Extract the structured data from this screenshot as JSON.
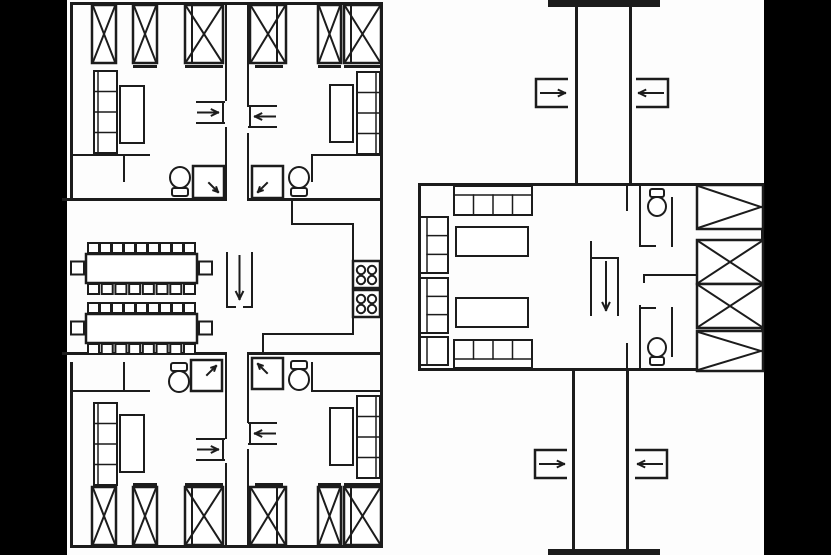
{
  "meta": {
    "title": "dormitory-floor-plan",
    "width": 831,
    "height": 555,
    "background_color": "#fdfdfd",
    "ink_color": "#1c1c1c",
    "margin_color": "#000000"
  },
  "plan": {
    "elements": [
      {
        "type": "bar",
        "name": "left-margin-bar",
        "x": 0,
        "y": 0,
        "w": 67,
        "h": 555,
        "fill": "#000000"
      },
      {
        "type": "bar",
        "name": "right-margin-bar",
        "x": 764,
        "y": 0,
        "w": 67,
        "h": 555,
        "fill": "#000000"
      },
      {
        "type": "bar",
        "name": "block-a-top-wall",
        "x": 70,
        "y": 2,
        "w": 313,
        "h": 3
      },
      {
        "type": "bar",
        "name": "block-a-left-wall-upper",
        "x": 70,
        "y": 2,
        "w": 3,
        "h": 198
      },
      {
        "type": "bar",
        "name": "block-a-left-wall-lower",
        "x": 70,
        "y": 362,
        "w": 3,
        "h": 186
      },
      {
        "type": "bar",
        "name": "block-a-right-wall",
        "x": 380,
        "y": 2,
        "w": 3,
        "h": 546
      },
      {
        "type": "bar",
        "name": "block-a-bottom-wall",
        "x": 70,
        "y": 545,
        "w": 313,
        "h": 3
      },
      {
        "type": "bar",
        "name": "block-a-upper-mid-wall-left",
        "x": 62,
        "y": 198,
        "w": 165,
        "h": 3
      },
      {
        "type": "bar",
        "name": "block-a-upper-mid-wall-right",
        "x": 247,
        "y": 198,
        "w": 136,
        "h": 3
      },
      {
        "type": "bar",
        "name": "block-a-lower-mid-wall-left",
        "x": 62,
        "y": 352,
        "w": 165,
        "h": 3
      },
      {
        "type": "bar",
        "name": "block-a-lower-mid-wall-right",
        "x": 247,
        "y": 352,
        "w": 136,
        "h": 3
      },
      {
        "type": "bar",
        "name": "top-strip-left-wall",
        "x": 225,
        "y": 2,
        "w": 2,
        "h": 99
      },
      {
        "type": "bar",
        "name": "top-strip-left-wall",
        "x": 225,
        "y": 127,
        "w": 2,
        "h": 74
      },
      {
        "type": "bar",
        "name": "top-strip-right-wall",
        "x": 247,
        "y": 2,
        "w": 2,
        "h": 105
      },
      {
        "type": "bar",
        "name": "top-strip-right-wall",
        "x": 247,
        "y": 133,
        "w": 2,
        "h": 68
      },
      {
        "type": "bar",
        "name": "bottom-strip-left-wall",
        "x": 225,
        "y": 355,
        "w": 2,
        "h": 84
      },
      {
        "type": "bar",
        "name": "bottom-strip-left-wall",
        "x": 225,
        "y": 463,
        "w": 2,
        "h": 82
      },
      {
        "type": "bar",
        "name": "bottom-strip-right-wall",
        "x": 247,
        "y": 355,
        "w": 2,
        "h": 68
      },
      {
        "type": "bar",
        "name": "bottom-strip-right-wall",
        "x": 247,
        "y": 449,
        "w": 2,
        "h": 96
      },
      {
        "type": "bar",
        "name": "kitchen-wall",
        "x": 291,
        "y": 201,
        "w": 2,
        "h": 24
      },
      {
        "type": "bar",
        "name": "kitchen-wall",
        "x": 291,
        "y": 223,
        "w": 63,
        "h": 2
      },
      {
        "type": "bar",
        "name": "kitchen-wall",
        "x": 352,
        "y": 223,
        "w": 2,
        "h": 112
      },
      {
        "type": "bar",
        "name": "kitchen-wall",
        "x": 262,
        "y": 333,
        "w": 92,
        "h": 2
      },
      {
        "type": "bar",
        "name": "kitchen-wall",
        "x": 262,
        "y": 333,
        "w": 2,
        "h": 21
      },
      {
        "type": "bar",
        "name": "wc-partition",
        "x": 70,
        "y": 154,
        "w": 80,
        "h": 2
      },
      {
        "type": "bar",
        "name": "wc-partition",
        "x": 123,
        "y": 154,
        "w": 2,
        "h": 28
      },
      {
        "type": "bar",
        "name": "wc-partition",
        "x": 311,
        "y": 154,
        "w": 70,
        "h": 2
      },
      {
        "type": "bar",
        "name": "wc-partition",
        "x": 311,
        "y": 154,
        "w": 2,
        "h": 28
      },
      {
        "type": "bar",
        "name": "wc-partition",
        "x": 70,
        "y": 390,
        "w": 80,
        "h": 2
      },
      {
        "type": "bar",
        "name": "wc-partition",
        "x": 123,
        "y": 362,
        "w": 2,
        "h": 28
      },
      {
        "type": "bar",
        "name": "wc-partition",
        "x": 311,
        "y": 390,
        "w": 70,
        "h": 2
      },
      {
        "type": "bar",
        "name": "wc-partition",
        "x": 311,
        "y": 362,
        "w": 2,
        "h": 28
      },
      {
        "type": "xbox",
        "name": "wardrobe-xbox",
        "x": 92,
        "y": 5,
        "w": 24,
        "h": 58
      },
      {
        "type": "xbox",
        "name": "wardrobe-xbox",
        "x": 133,
        "y": 5,
        "w": 24,
        "h": 58
      },
      {
        "type": "xbox",
        "name": "wardrobe-xbox",
        "x": 185,
        "y": 5,
        "w": 38,
        "h": 58
      },
      {
        "type": "bar",
        "name": "wardrobe-divider",
        "x": 191,
        "y": 5,
        "w": 2,
        "h": 58
      },
      {
        "type": "bar",
        "name": "wardrobe-foot",
        "x": 133,
        "y": 65,
        "w": 24,
        "h": 3
      },
      {
        "type": "bar",
        "name": "wardrobe-foot",
        "x": 185,
        "y": 65,
        "w": 38,
        "h": 3
      },
      {
        "type": "bed",
        "name": "bunk-shelf-bed",
        "x": 94,
        "y": 71,
        "w": 23,
        "h": 82,
        "side": "left"
      },
      {
        "type": "box",
        "name": "desk",
        "x": 120,
        "y": 86,
        "w": 24,
        "h": 57
      },
      {
        "type": "door-arrow",
        "name": "door-swing-arrow",
        "x": 197,
        "y": 102,
        "w": 27,
        "h": 21,
        "dir": "right"
      },
      {
        "type": "toilet",
        "name": "toilet-icon",
        "x": 169,
        "y": 166,
        "w": 22,
        "h": 31,
        "dir": "up"
      },
      {
        "type": "shower",
        "name": "shower-tray",
        "x": 193,
        "y": 166,
        "w": 31,
        "h": 32,
        "corner": "br"
      },
      {
        "type": "xbox",
        "name": "wardrobe-xbox",
        "x": 250,
        "y": 5,
        "w": 36,
        "h": 58
      },
      {
        "type": "bar",
        "name": "wardrobe-divider",
        "x": 276,
        "y": 5,
        "w": 2,
        "h": 58
      },
      {
        "type": "xbox",
        "name": "wardrobe-xbox",
        "x": 318,
        "y": 5,
        "w": 23,
        "h": 58
      },
      {
        "type": "xbox",
        "name": "wardrobe-xbox",
        "x": 344,
        "y": 5,
        "w": 37,
        "h": 58
      },
      {
        "type": "bar",
        "name": "wardrobe-divider",
        "x": 350,
        "y": 5,
        "w": 2,
        "h": 58
      },
      {
        "type": "bar",
        "name": "wardrobe-foot",
        "x": 255,
        "y": 65,
        "w": 28,
        "h": 3
      },
      {
        "type": "bar",
        "name": "wardrobe-foot",
        "x": 318,
        "y": 65,
        "w": 23,
        "h": 3
      },
      {
        "type": "bar",
        "name": "wardrobe-foot",
        "x": 344,
        "y": 65,
        "w": 37,
        "h": 3
      },
      {
        "type": "bed",
        "name": "bunk-shelf-bed",
        "x": 357,
        "y": 72,
        "w": 23,
        "h": 82,
        "side": "right"
      },
      {
        "type": "box",
        "name": "desk",
        "x": 330,
        "y": 85,
        "w": 23,
        "h": 57
      },
      {
        "type": "door-arrow",
        "name": "door-swing-arrow",
        "x": 249,
        "y": 106,
        "w": 27,
        "h": 21,
        "dir": "left"
      },
      {
        "type": "shower",
        "name": "shower-tray",
        "x": 252,
        "y": 166,
        "w": 31,
        "h": 32,
        "corner": "bl"
      },
      {
        "type": "toilet",
        "name": "toilet-icon",
        "x": 288,
        "y": 166,
        "w": 22,
        "h": 31,
        "dir": "up"
      },
      {
        "type": "table",
        "name": "dining-table",
        "x": 86,
        "y": 254,
        "w": 111,
        "h": 29,
        "top": 9,
        "bottom": 8
      },
      {
        "type": "table",
        "name": "dining-table",
        "x": 86,
        "y": 314,
        "w": 111,
        "h": 29,
        "top": 9,
        "bottom": 8
      },
      {
        "type": "entry-u",
        "name": "entrance-arrow",
        "x": 227,
        "y": 253,
        "w": 25,
        "h": 54
      },
      {
        "type": "stove",
        "name": "kitchen-stove",
        "x": 353,
        "y": 261,
        "w": 27,
        "h": 27
      },
      {
        "type": "stove",
        "name": "kitchen-stove",
        "x": 353,
        "y": 290,
        "w": 27,
        "h": 27
      },
      {
        "type": "toilet",
        "name": "toilet-icon",
        "x": 168,
        "y": 362,
        "w": 22,
        "h": 31,
        "dir": "down"
      },
      {
        "type": "shower",
        "name": "shower-tray",
        "x": 191,
        "y": 360,
        "w": 31,
        "h": 31,
        "corner": "tr"
      },
      {
        "type": "bed",
        "name": "bunk-shelf-bed",
        "x": 94,
        "y": 403,
        "w": 23,
        "h": 82,
        "side": "left"
      },
      {
        "type": "box",
        "name": "desk",
        "x": 120,
        "y": 415,
        "w": 24,
        "h": 57
      },
      {
        "type": "door-arrow",
        "name": "door-swing-arrow",
        "x": 197,
        "y": 439,
        "w": 27,
        "h": 21,
        "dir": "right"
      },
      {
        "type": "xbox",
        "name": "wardrobe-xbox",
        "x": 92,
        "y": 487,
        "w": 24,
        "h": 58
      },
      {
        "type": "xbox",
        "name": "wardrobe-xbox",
        "x": 133,
        "y": 487,
        "w": 24,
        "h": 58
      },
      {
        "type": "xbox",
        "name": "wardrobe-xbox",
        "x": 185,
        "y": 487,
        "w": 38,
        "h": 58
      },
      {
        "type": "bar",
        "name": "wardrobe-divider",
        "x": 191,
        "y": 487,
        "w": 2,
        "h": 58
      },
      {
        "type": "bar",
        "name": "wardrobe-foot",
        "x": 133,
        "y": 483,
        "w": 24,
        "h": 3
      },
      {
        "type": "bar",
        "name": "wardrobe-foot",
        "x": 185,
        "y": 483,
        "w": 38,
        "h": 3
      },
      {
        "type": "shower",
        "name": "shower-tray",
        "x": 252,
        "y": 358,
        "w": 31,
        "h": 31,
        "corner": "tl"
      },
      {
        "type": "toilet",
        "name": "toilet-icon",
        "x": 288,
        "y": 360,
        "w": 22,
        "h": 31,
        "dir": "down"
      },
      {
        "type": "bed",
        "name": "bunk-shelf-bed",
        "x": 357,
        "y": 396,
        "w": 23,
        "h": 82,
        "side": "right"
      },
      {
        "type": "box",
        "name": "desk",
        "x": 330,
        "y": 408,
        "w": 23,
        "h": 57
      },
      {
        "type": "door-arrow",
        "name": "door-swing-arrow",
        "x": 249,
        "y": 423,
        "w": 27,
        "h": 21,
        "dir": "left"
      },
      {
        "type": "xbox",
        "name": "wardrobe-xbox",
        "x": 250,
        "y": 487,
        "w": 36,
        "h": 58
      },
      {
        "type": "bar",
        "name": "wardrobe-divider",
        "x": 276,
        "y": 487,
        "w": 2,
        "h": 58
      },
      {
        "type": "xbox",
        "name": "wardrobe-xbox",
        "x": 318,
        "y": 487,
        "w": 23,
        "h": 58
      },
      {
        "type": "xbox",
        "name": "wardrobe-xbox",
        "x": 344,
        "y": 487,
        "w": 37,
        "h": 58
      },
      {
        "type": "bar",
        "name": "wardrobe-divider",
        "x": 350,
        "y": 487,
        "w": 2,
        "h": 58
      },
      {
        "type": "bar",
        "name": "wardrobe-foot",
        "x": 255,
        "y": 483,
        "w": 28,
        "h": 3
      },
      {
        "type": "bar",
        "name": "wardrobe-foot",
        "x": 318,
        "y": 483,
        "w": 23,
        "h": 3
      },
      {
        "type": "bar",
        "name": "wardrobe-foot",
        "x": 344,
        "y": 483,
        "w": 37,
        "h": 3
      },
      {
        "type": "bar",
        "name": "block-b-top-wall",
        "x": 418,
        "y": 183,
        "w": 346,
        "h": 3
      },
      {
        "type": "bar",
        "name": "block-b-bottom-wall",
        "x": 418,
        "y": 368,
        "w": 346,
        "h": 3
      },
      {
        "type": "bar",
        "name": "block-b-left-wall",
        "x": 418,
        "y": 183,
        "w": 3,
        "h": 188
      },
      {
        "type": "bar",
        "name": "block-b-right-wall",
        "x": 761,
        "y": 183,
        "w": 3,
        "h": 188
      },
      {
        "type": "bar",
        "name": "corridor-top-left-wall",
        "x": 575,
        "y": 6,
        "w": 3,
        "h": 177
      },
      {
        "type": "bar",
        "name": "corridor-top-right-wall",
        "x": 629,
        "y": 6,
        "w": 3,
        "h": 177
      },
      {
        "type": "bar",
        "name": "corridor-top-cap",
        "x": 548,
        "y": 0,
        "w": 112,
        "h": 7
      },
      {
        "type": "bar",
        "name": "corridor-bottom-left-wall",
        "x": 572,
        "y": 371,
        "w": 3,
        "h": 178
      },
      {
        "type": "bar",
        "name": "corridor-bottom-right-wall",
        "x": 626,
        "y": 371,
        "w": 3,
        "h": 178
      },
      {
        "type": "bar",
        "name": "corridor-bottom-cap",
        "x": 548,
        "y": 549,
        "w": 112,
        "h": 6
      },
      {
        "type": "corridor-door",
        "name": "corridor-door-arrow",
        "x": 536,
        "y": 79,
        "w": 32,
        "h": 28,
        "dir": "right"
      },
      {
        "type": "corridor-door",
        "name": "corridor-door-arrow",
        "x": 636,
        "y": 79,
        "w": 32,
        "h": 28,
        "dir": "left"
      },
      {
        "type": "corridor-door",
        "name": "corridor-door-arrow",
        "x": 535,
        "y": 450,
        "w": 32,
        "h": 28,
        "dir": "right"
      },
      {
        "type": "corridor-door",
        "name": "corridor-door-arrow",
        "x": 635,
        "y": 450,
        "w": 32,
        "h": 28,
        "dir": "left"
      },
      {
        "type": "sofa-h",
        "name": "sofa",
        "x": 454,
        "y": 186,
        "w": 78,
        "h": 29,
        "back": "top"
      },
      {
        "type": "sofa-h",
        "name": "sofa",
        "x": 454,
        "y": 340,
        "w": 78,
        "h": 28,
        "back": "bottom"
      },
      {
        "type": "sofa-v",
        "name": "sofa",
        "x": 420,
        "y": 217,
        "w": 28,
        "h": 56
      },
      {
        "type": "sofa-v",
        "name": "sofa",
        "x": 420,
        "y": 278,
        "w": 28,
        "h": 55
      },
      {
        "type": "sofa-v",
        "name": "armchair",
        "x": 420,
        "y": 337,
        "w": 28,
        "h": 28
      },
      {
        "type": "box",
        "name": "coffee-table",
        "x": 456,
        "y": 227,
        "w": 72,
        "h": 29
      },
      {
        "type": "box",
        "name": "coffee-table",
        "x": 456,
        "y": 298,
        "w": 72,
        "h": 29
      },
      {
        "type": "entry-bracket",
        "name": "entrance-arrow",
        "x": 591,
        "y": 242,
        "w": 28,
        "h": 73
      },
      {
        "type": "bar",
        "name": "wc-jamb",
        "x": 626,
        "y": 183,
        "w": 2,
        "h": 28
      },
      {
        "type": "bar",
        "name": "wc-jamb",
        "x": 626,
        "y": 343,
        "w": 2,
        "h": 28
      },
      {
        "type": "bar",
        "name": "wc-wall",
        "x": 639,
        "y": 183,
        "w": 2,
        "h": 64
      },
      {
        "type": "bar",
        "name": "wc-wall",
        "x": 671,
        "y": 197,
        "w": 2,
        "h": 50
      },
      {
        "type": "bar",
        "name": "wc-wall",
        "x": 639,
        "y": 245,
        "w": 17,
        "h": 2
      },
      {
        "type": "bar",
        "name": "wc-wall",
        "x": 643,
        "y": 274,
        "w": 54,
        "h": 2
      },
      {
        "type": "bar",
        "name": "wc-wall",
        "x": 643,
        "y": 274,
        "w": 2,
        "h": 9
      },
      {
        "type": "bar",
        "name": "wc-wall",
        "x": 639,
        "y": 305,
        "w": 2,
        "h": 64
      },
      {
        "type": "bar",
        "name": "wc-wall",
        "x": 671,
        "y": 307,
        "w": 2,
        "h": 50
      },
      {
        "type": "bar",
        "name": "wc-wall",
        "x": 639,
        "y": 307,
        "w": 17,
        "h": 2
      },
      {
        "type": "toilet",
        "name": "toilet-icon",
        "x": 647,
        "y": 188,
        "w": 20,
        "h": 29,
        "dir": "down"
      },
      {
        "type": "toilet",
        "name": "toilet-icon",
        "x": 647,
        "y": 337,
        "w": 20,
        "h": 29,
        "dir": "up"
      },
      {
        "type": "tribox",
        "name": "closet-tribox",
        "x": 697,
        "y": 185,
        "w": 66,
        "h": 44
      },
      {
        "type": "xbox",
        "name": "closet-xbox",
        "x": 697,
        "y": 240,
        "w": 66,
        "h": 44
      },
      {
        "type": "xbox",
        "name": "closet-xbox",
        "x": 697,
        "y": 284,
        "w": 66,
        "h": 44
      },
      {
        "type": "tribox",
        "name": "closet-tribox",
        "x": 697,
        "y": 331,
        "w": 66,
        "h": 40
      }
    ]
  }
}
